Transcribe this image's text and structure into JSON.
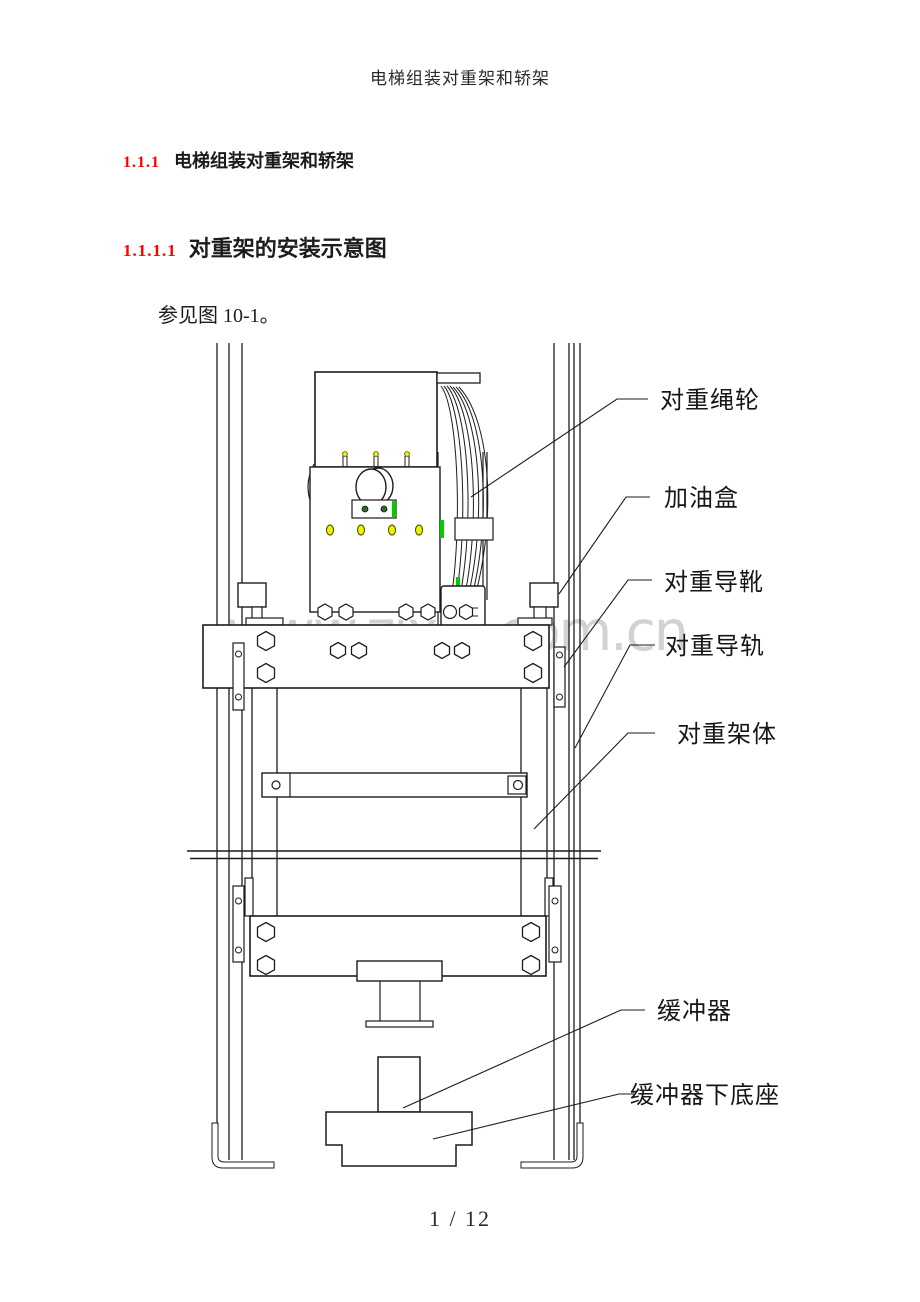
{
  "page": {
    "header": "电梯组装对重架和轿架",
    "footer": "1 / 12",
    "watermark": "www.zixin.com.cn"
  },
  "headings": {
    "h1": {
      "number": "1.1.1",
      "text": "电梯组装对重架和轿架"
    },
    "h2": {
      "number": "1.1.1.1",
      "text": "对重架的安装示意图"
    }
  },
  "paragraph": {
    "see_figure": "参见图 10-1。"
  },
  "figure": {
    "name": "图 10-1 对重架的安装示意图",
    "labels": {
      "rope_sheave": "对重绳轮",
      "oil_box": "加油盒",
      "guide_shoe": "对重导靴",
      "guide_rail": "对重导轨",
      "frame_body": "对重架体",
      "buffer": "缓冲器",
      "buffer_base": "缓冲器下底座"
    }
  },
  "colors": {
    "heading_number_red": "#ff0000",
    "accent_green": "#00cc00",
    "accent_dark_green": "#2d6a2d",
    "accent_yellow": "#f0f000",
    "watermark_gray": "#d2d2d2",
    "line_black": "#1c1c1c"
  }
}
